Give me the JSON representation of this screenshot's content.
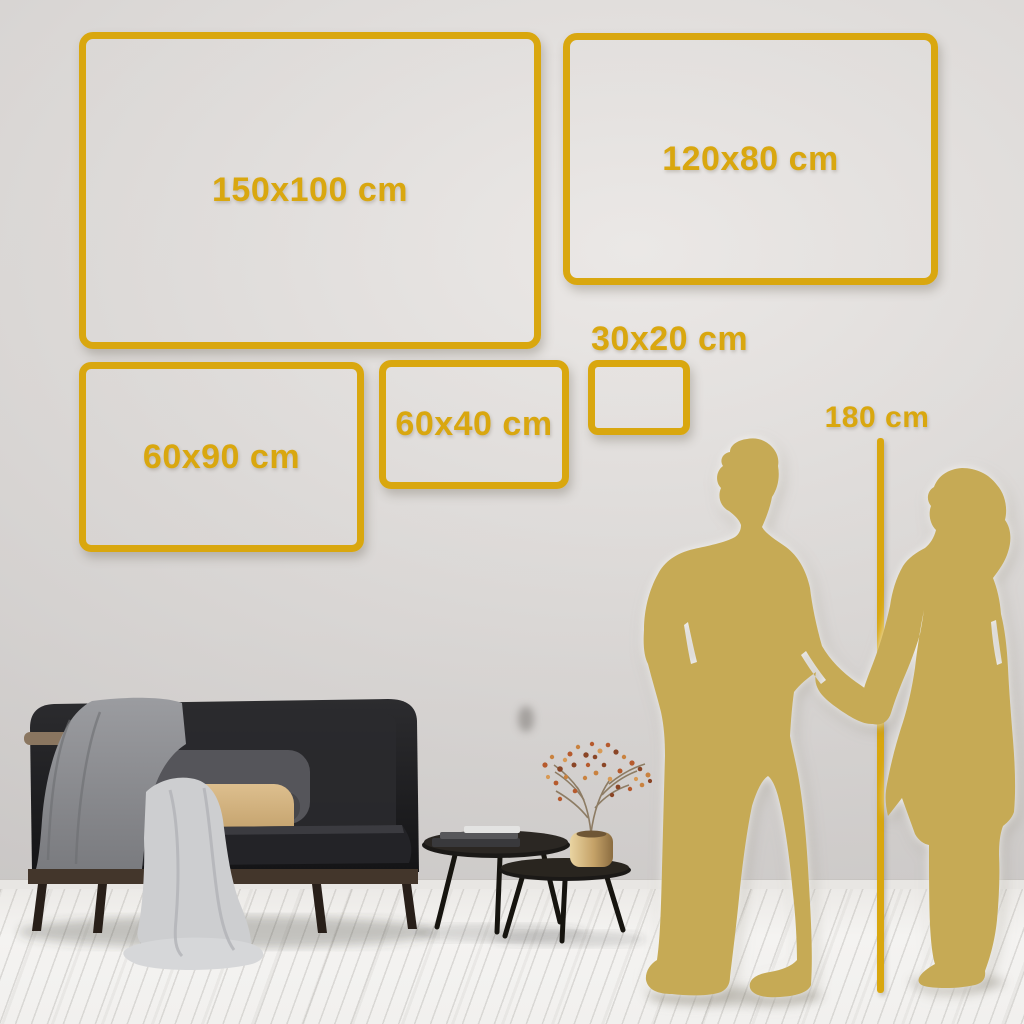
{
  "scene": {
    "description": "Wall art canvas size guide with living room"
  },
  "frames": [
    {
      "id": "150x100",
      "label": "150x100 cm"
    },
    {
      "id": "120x80",
      "label": "120x80 cm"
    },
    {
      "id": "60x90",
      "label": "60x90 cm"
    },
    {
      "id": "60x40",
      "label": "60x40 cm"
    },
    {
      "id": "30x20",
      "label": "30x20 cm"
    }
  ],
  "height_reference": {
    "label": "180 cm"
  },
  "colors": {
    "accent_gold": "#D9A70F",
    "silhouette_gold": "#C6AA55",
    "wall": "#D8D5D3",
    "floor": "#F3F2F0"
  }
}
